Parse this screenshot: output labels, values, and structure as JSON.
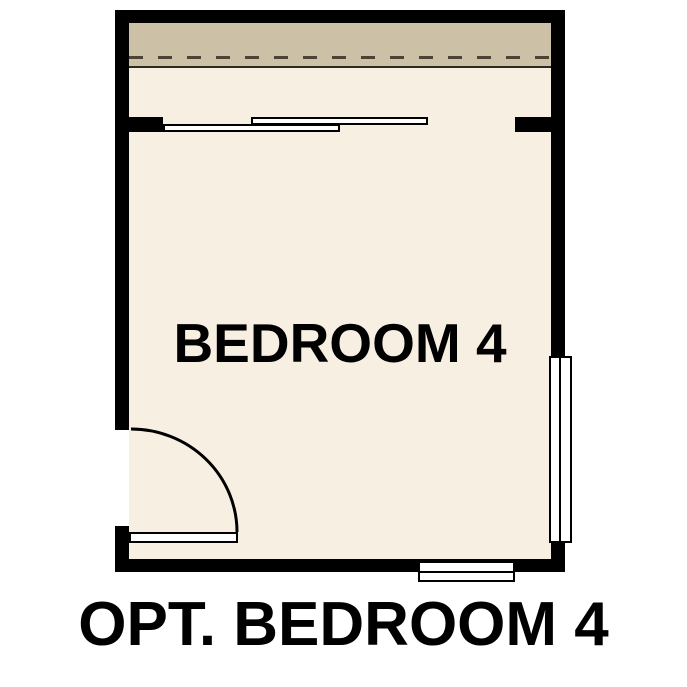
{
  "plan": {
    "room_label": "BEDROOM 4",
    "title": "OPT. BEDROOM 4"
  },
  "colors": {
    "wall": "#000000",
    "floor": "#f7efe2",
    "closet_band": "#ccc1a6",
    "band_edge": "#2e2a20",
    "dashed_line": "#4a4336",
    "background": "#ffffff",
    "text": "#000000"
  }
}
